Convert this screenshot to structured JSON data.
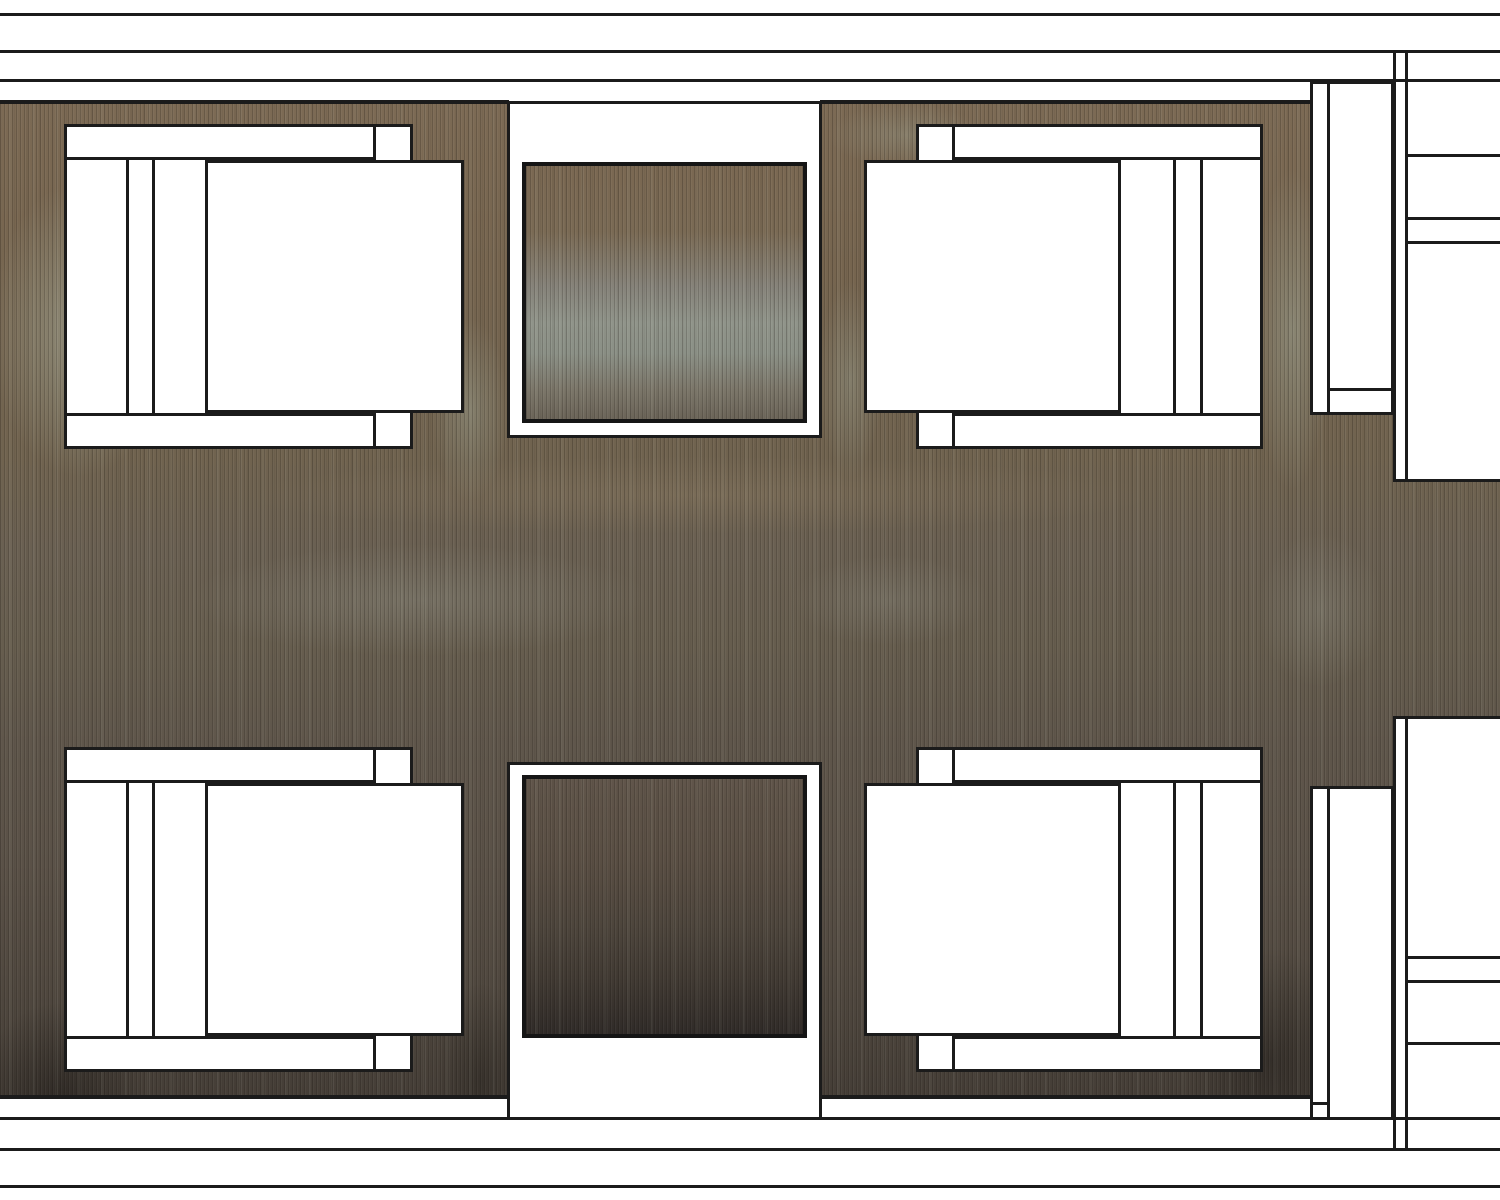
{
  "drawing": {
    "title": "furniture-plan-drawing",
    "type": "architectural plan view, no visible text",
    "canvas": {
      "width": 1500,
      "height": 1200
    }
  },
  "palette": {
    "paper_white": "#ffffff",
    "line_black": "#1b1b1b",
    "rug_base_stops": [
      "#7d6b55 6%",
      "#76654f 22%",
      "#70634f 38%",
      "#6a6052 46%",
      "#665d4e 54%",
      "#5f564b 62%",
      "#5a5147 72%",
      "#50483f 82%",
      "#443d36 92%",
      "#332e2a 100%"
    ],
    "rug_patches": [
      {
        "x": 80,
        "y": 330,
        "rx": 130,
        "ry": 210,
        "color": "rgba(168,175,158,0.55)"
      },
      {
        "x": 190,
        "y": 170,
        "rx": 90,
        "ry": 55,
        "color": "rgba(168,175,158,0.30)"
      },
      {
        "x": 470,
        "y": 410,
        "rx": 55,
        "ry": 130,
        "color": "rgba(160,168,152,0.40)"
      },
      {
        "x": 850,
        "y": 380,
        "rx": 45,
        "ry": 140,
        "color": "rgba(158,165,150,0.40)"
      },
      {
        "x": 905,
        "y": 135,
        "rx": 110,
        "ry": 45,
        "color": "rgba(160,168,152,0.32)"
      },
      {
        "x": 1292,
        "y": 330,
        "rx": 55,
        "ry": 230,
        "color": "rgba(160,168,152,0.50)"
      },
      {
        "x": 1320,
        "y": 610,
        "rx": 90,
        "ry": 110,
        "color": "rgba(150,152,142,0.30)"
      },
      {
        "x": 420,
        "y": 600,
        "rx": 330,
        "ry": 80,
        "color": "rgba(150,152,142,0.33)"
      },
      {
        "x": 890,
        "y": 600,
        "rx": 140,
        "ry": 65,
        "color": "rgba(148,150,140,0.28)"
      },
      {
        "x": 700,
        "y": 495,
        "rx": 650,
        "ry": 55,
        "color": "rgba(170,150,118,0.20)"
      },
      {
        "x": 60,
        "y": 1100,
        "rx": 120,
        "ry": 140,
        "color": "rgba(15,13,12,0.40)"
      },
      {
        "x": 1270,
        "y": 1060,
        "rx": 120,
        "ry": 160,
        "color": "rgba(15,13,12,0.35)"
      },
      {
        "x": 480,
        "y": 1080,
        "rx": 60,
        "ry": 140,
        "color": "rgba(20,18,15,0.30)"
      }
    ],
    "table_top_stops": [
      "#7a6852 0%",
      "#7a6a54 26%",
      "#86837a 48%",
      "#90948a 62%",
      "#8b9086 74%",
      "#7c776a 88%",
      "#6b6458 100%"
    ],
    "table_bottom_stops": [
      "#60554a 0%",
      "#594e43 32%",
      "#4d453c 58%",
      "#413a33 78%",
      "#302b28 100%"
    ]
  },
  "scene": {
    "shapes": [
      {
        "name": "wall-band-top",
        "kind": "white",
        "x": 0,
        "y": 0,
        "w": 1500,
        "h": 101
      },
      {
        "name": "wall-band-bottom",
        "kind": "white",
        "x": 0,
        "y": 1098,
        "w": 1500,
        "h": 102
      },
      {
        "name": "right-panel-upper",
        "kind": "white",
        "x": 1394,
        "y": 0,
        "w": 106,
        "h": 482
      },
      {
        "name": "right-panel-lower",
        "kind": "white",
        "x": 1394,
        "y": 716,
        "w": 106,
        "h": 484
      },
      {
        "name": "wall-line-top-outer",
        "kind": "line",
        "x": 0,
        "y": 13,
        "w": 1500,
        "h": 3
      },
      {
        "name": "wall-line-top-middle",
        "kind": "line",
        "x": 0,
        "y": 50,
        "w": 1500,
        "h": 3
      },
      {
        "name": "wall-line-top-inner",
        "kind": "line",
        "x": 0,
        "y": 79,
        "w": 1500,
        "h": 3
      },
      {
        "name": "wall-line-bottom-inner",
        "kind": "line",
        "x": 0,
        "y": 1117,
        "w": 1500,
        "h": 3
      },
      {
        "name": "wall-line-bottom-middle",
        "kind": "line",
        "x": 0,
        "y": 1148,
        "w": 1500,
        "h": 3
      },
      {
        "name": "wall-line-bottom-outer",
        "kind": "line",
        "x": 0,
        "y": 1185,
        "w": 1500,
        "h": 3
      },
      {
        "name": "rug-edge-top-left",
        "kind": "line",
        "x": 0,
        "y": 100,
        "w": 509,
        "h": 4
      },
      {
        "name": "rug-edge-top-right",
        "kind": "line",
        "x": 820,
        "y": 100,
        "w": 490,
        "h": 4
      },
      {
        "name": "rug-edge-bottom-left",
        "kind": "line",
        "x": 0,
        "y": 1095,
        "w": 509,
        "h": 4
      },
      {
        "name": "rug-edge-bottom-right",
        "kind": "line",
        "x": 820,
        "y": 1095,
        "w": 490,
        "h": 4
      },
      {
        "name": "partition-block-upper",
        "kind": "white-border",
        "x": 1310,
        "y": 81,
        "w": 84,
        "h": 334
      },
      {
        "name": "partition-block-lower",
        "kind": "white-border",
        "x": 1310,
        "y": 786,
        "w": 84,
        "h": 334
      },
      {
        "name": "partition-upper-vline",
        "kind": "line",
        "x": 1327,
        "y": 81,
        "w": 3,
        "h": 334
      },
      {
        "name": "partition-upper-hline",
        "kind": "line",
        "x": 1327,
        "y": 388,
        "w": 67,
        "h": 3
      },
      {
        "name": "partition-lower-vline",
        "kind": "line",
        "x": 1327,
        "y": 786,
        "w": 3,
        "h": 334
      },
      {
        "name": "partition-lower-hline",
        "kind": "line",
        "x": 1310,
        "y": 1102,
        "w": 20,
        "h": 3
      },
      {
        "name": "right-wall-upper-left-line",
        "kind": "line",
        "x": 1393,
        "y": 50,
        "w": 3,
        "h": 432
      },
      {
        "name": "right-wall-upper-right-line",
        "kind": "line",
        "x": 1405,
        "y": 50,
        "w": 3,
        "h": 432
      },
      {
        "name": "right-wall-lower-left-line",
        "kind": "line",
        "x": 1393,
        "y": 716,
        "w": 3,
        "h": 435
      },
      {
        "name": "right-wall-lower-right-line",
        "kind": "line",
        "x": 1405,
        "y": 716,
        "w": 3,
        "h": 435
      },
      {
        "name": "rug-mid-edge-top",
        "kind": "line",
        "x": 1394,
        "y": 479,
        "w": 106,
        "h": 3
      },
      {
        "name": "rug-mid-edge-bottom",
        "kind": "line",
        "x": 1394,
        "y": 716,
        "w": 106,
        "h": 3
      },
      {
        "name": "right-panel-shelf-line-1",
        "kind": "line",
        "x": 1406,
        "y": 154,
        "w": 94,
        "h": 3
      },
      {
        "name": "right-panel-shelf-line-2",
        "kind": "line",
        "x": 1406,
        "y": 217,
        "w": 94,
        "h": 3
      },
      {
        "name": "right-panel-shelf-line-3",
        "kind": "line",
        "x": 1406,
        "y": 241,
        "w": 94,
        "h": 3
      },
      {
        "name": "right-panel-shelf-line-4",
        "kind": "line",
        "x": 1406,
        "y": 956,
        "w": 94,
        "h": 3
      },
      {
        "name": "right-panel-shelf-line-5",
        "kind": "line",
        "x": 1406,
        "y": 980,
        "w": 94,
        "h": 3
      },
      {
        "name": "right-panel-shelf-line-6",
        "kind": "line",
        "x": 1406,
        "y": 1042,
        "w": 94,
        "h": 3
      },
      {
        "name": "table-alcove-top",
        "kind": "white-border",
        "x": 507,
        "y": 101,
        "w": 315,
        "h": 337
      },
      {
        "name": "table-alcove-bottom",
        "kind": "white-border",
        "x": 507,
        "y": 762,
        "w": 315,
        "h": 358
      },
      {
        "name": "side-table-top",
        "kind": "table-top",
        "x": 522,
        "y": 162,
        "w": 285,
        "h": 261
      },
      {
        "name": "side-table-bottom",
        "kind": "table-bottom",
        "x": 522,
        "y": 775,
        "w": 285,
        "h": 263
      },
      {
        "name": "armchair-top-left-frame",
        "kind": "white-border",
        "x": 64,
        "y": 124,
        "w": 349,
        "h": 325
      },
      {
        "name": "armchair-top-left-armrest-a",
        "kind": "white-border",
        "x": 64,
        "y": 124,
        "w": 312,
        "h": 36
      },
      {
        "name": "armchair-top-left-armrest-b",
        "kind": "white-border",
        "x": 64,
        "y": 413,
        "w": 312,
        "h": 36
      },
      {
        "name": "armchair-top-left-back-line-1",
        "kind": "line",
        "x": 126,
        "y": 160,
        "w": 3,
        "h": 253
      },
      {
        "name": "armchair-top-left-back-line-2",
        "kind": "line",
        "x": 152,
        "y": 160,
        "w": 3,
        "h": 253
      },
      {
        "name": "armchair-top-left-seat",
        "kind": "white-border",
        "x": 205,
        "y": 160,
        "w": 259,
        "h": 253
      },
      {
        "name": "armchair-top-right-frame",
        "kind": "white-border",
        "x": 916,
        "y": 124,
        "w": 347,
        "h": 325
      },
      {
        "name": "armchair-top-right-armrest-a",
        "kind": "white-border",
        "x": 952,
        "y": 124,
        "w": 311,
        "h": 36
      },
      {
        "name": "armchair-top-right-armrest-b",
        "kind": "white-border",
        "x": 952,
        "y": 413,
        "w": 311,
        "h": 36
      },
      {
        "name": "armchair-top-right-back-line-1",
        "kind": "line",
        "x": 1173,
        "y": 160,
        "w": 3,
        "h": 253
      },
      {
        "name": "armchair-top-right-back-line-2",
        "kind": "line",
        "x": 1200,
        "y": 160,
        "w": 3,
        "h": 253
      },
      {
        "name": "armchair-top-right-seat",
        "kind": "white-border",
        "x": 864,
        "y": 160,
        "w": 257,
        "h": 253
      },
      {
        "name": "armchair-bottom-left-frame",
        "kind": "white-border",
        "x": 64,
        "y": 747,
        "w": 349,
        "h": 325
      },
      {
        "name": "armchair-bottom-left-armrest-a",
        "kind": "white-border",
        "x": 64,
        "y": 747,
        "w": 312,
        "h": 36
      },
      {
        "name": "armchair-bottom-left-armrest-b",
        "kind": "white-border",
        "x": 64,
        "y": 1036,
        "w": 312,
        "h": 36
      },
      {
        "name": "armchair-bottom-left-back-line-1",
        "kind": "line",
        "x": 126,
        "y": 783,
        "w": 3,
        "h": 253
      },
      {
        "name": "armchair-bottom-left-back-line-2",
        "kind": "line",
        "x": 152,
        "y": 783,
        "w": 3,
        "h": 253
      },
      {
        "name": "armchair-bottom-left-seat",
        "kind": "white-border",
        "x": 205,
        "y": 783,
        "w": 259,
        "h": 253
      },
      {
        "name": "armchair-bottom-right-frame",
        "kind": "white-border",
        "x": 916,
        "y": 747,
        "w": 347,
        "h": 325
      },
      {
        "name": "armchair-bottom-right-armrest-a",
        "kind": "white-border",
        "x": 952,
        "y": 747,
        "w": 311,
        "h": 36
      },
      {
        "name": "armchair-bottom-right-armrest-b",
        "kind": "white-border",
        "x": 952,
        "y": 1036,
        "w": 311,
        "h": 36
      },
      {
        "name": "armchair-bottom-right-back-line-1",
        "kind": "line",
        "x": 1173,
        "y": 783,
        "w": 3,
        "h": 253
      },
      {
        "name": "armchair-bottom-right-back-line-2",
        "kind": "line",
        "x": 1200,
        "y": 783,
        "w": 3,
        "h": 253
      },
      {
        "name": "armchair-bottom-right-seat",
        "kind": "white-border",
        "x": 864,
        "y": 783,
        "w": 257,
        "h": 253
      }
    ]
  }
}
